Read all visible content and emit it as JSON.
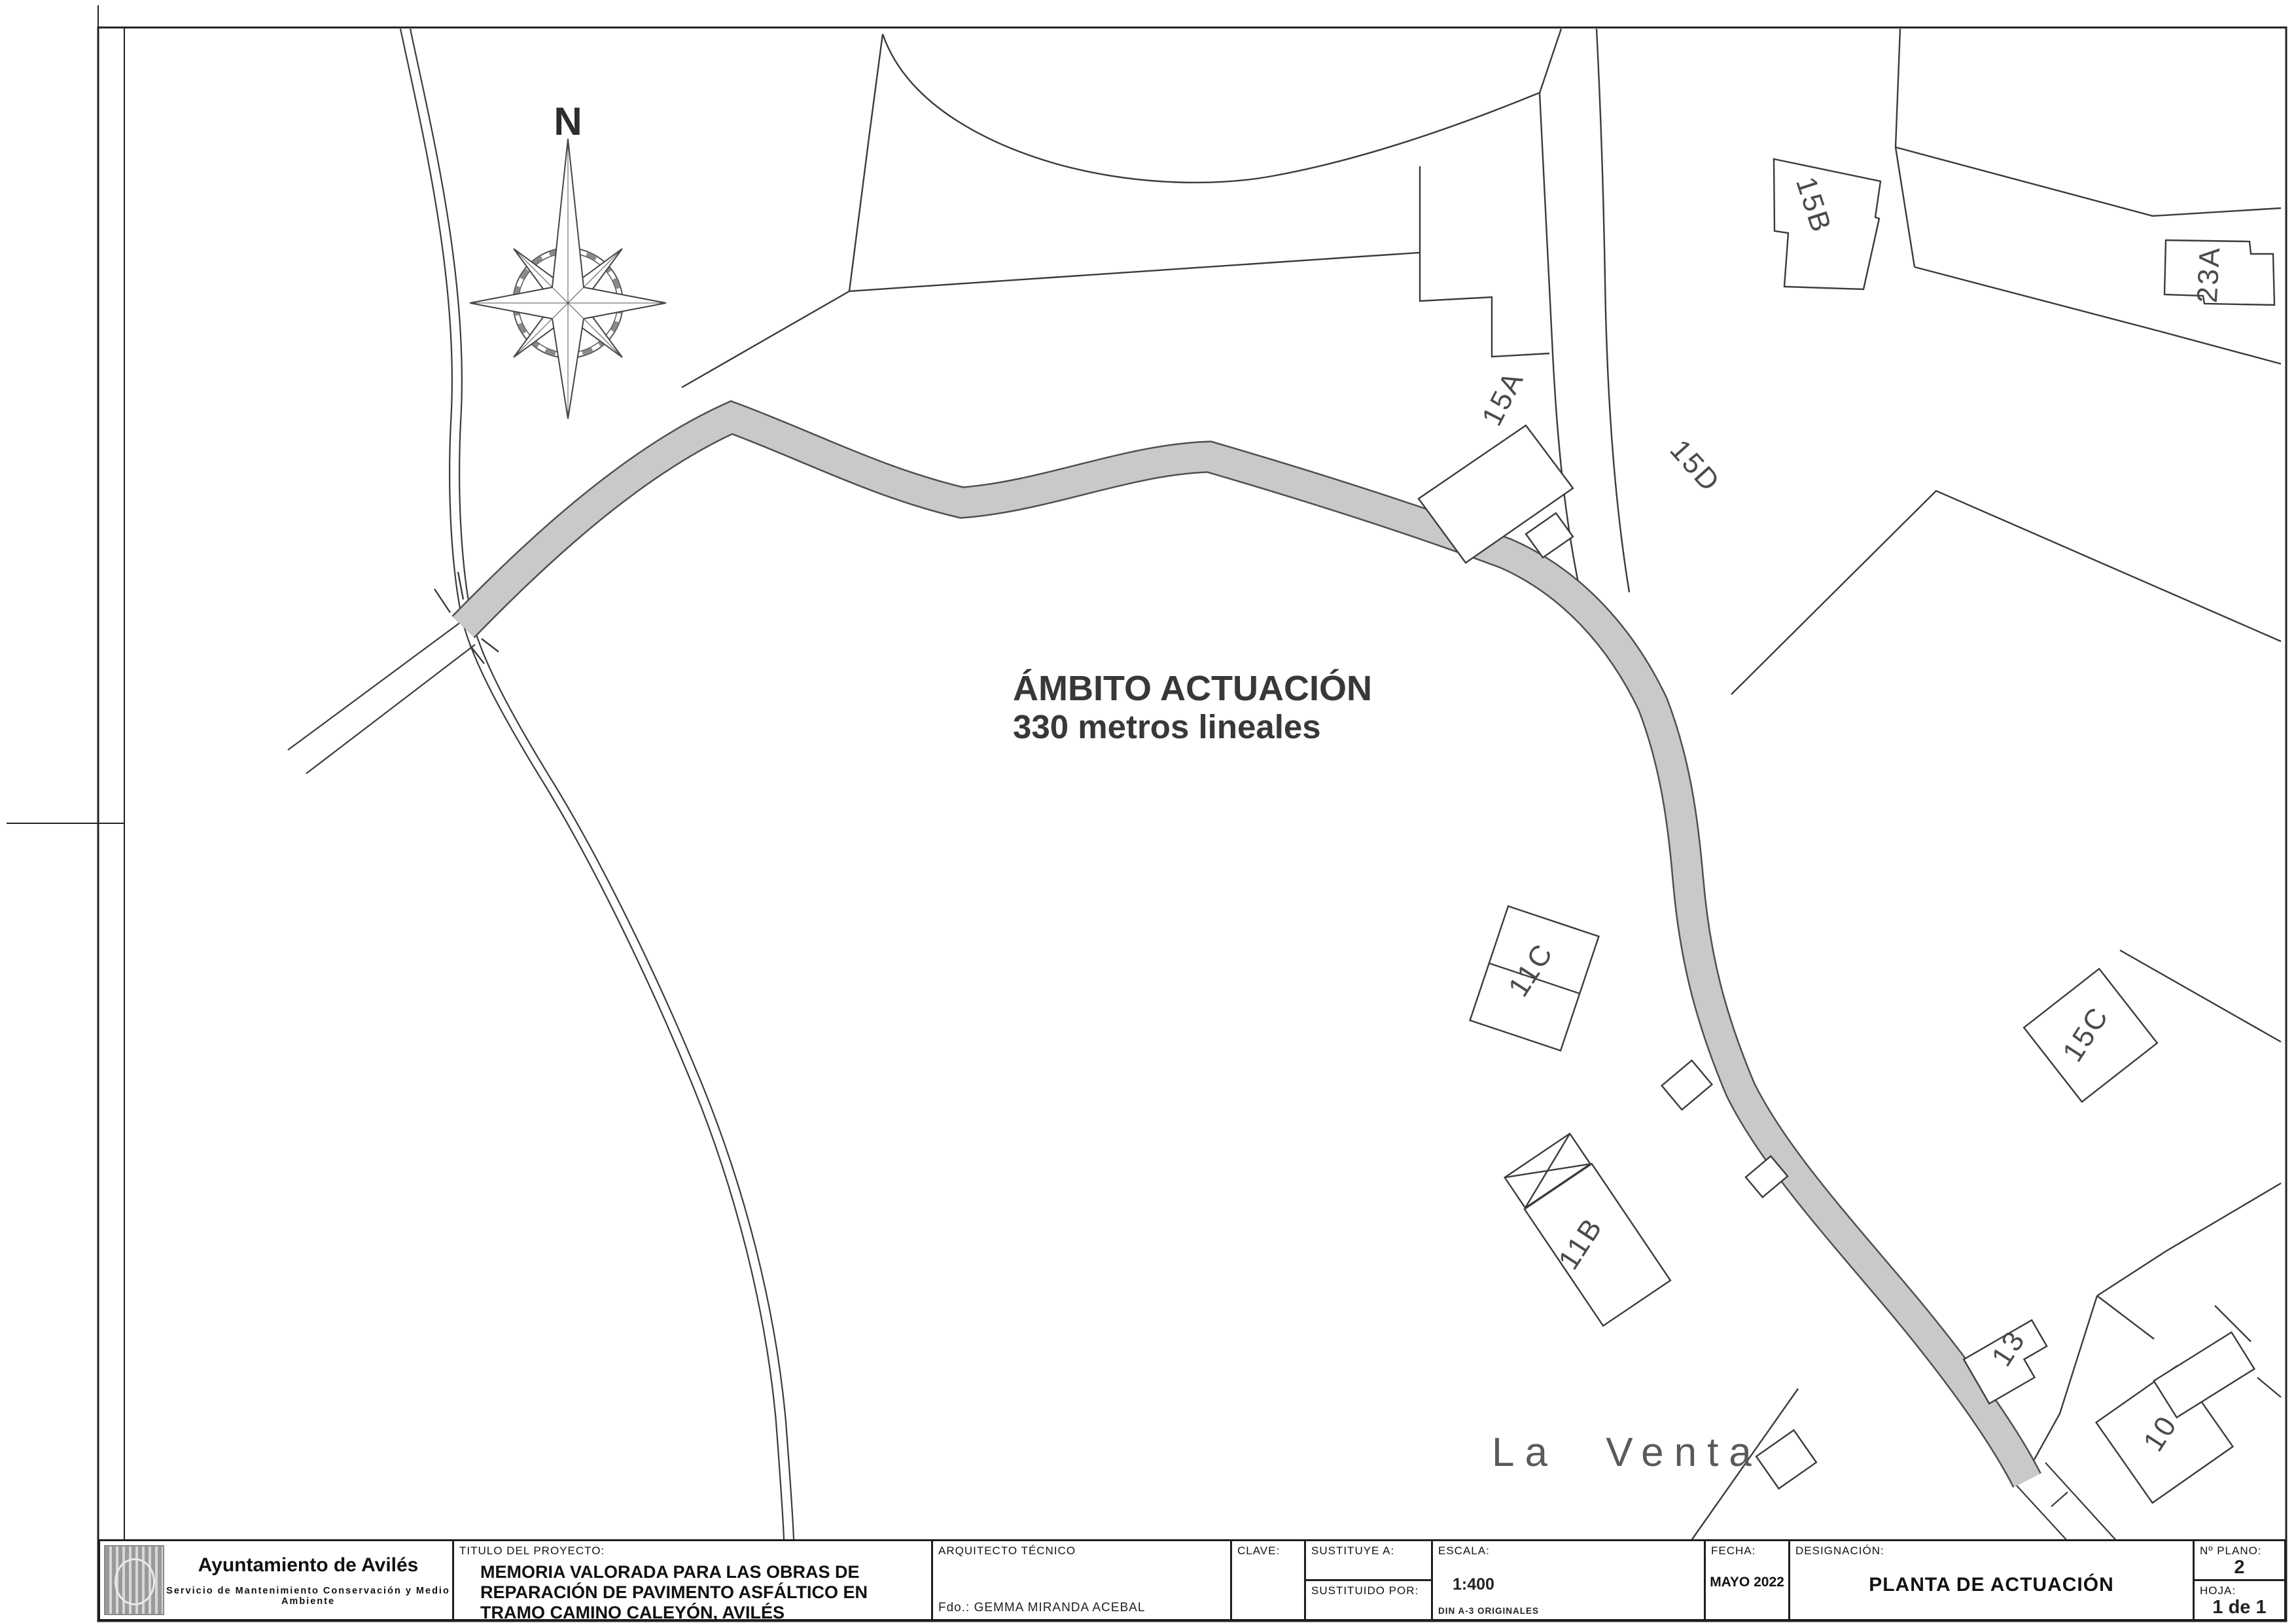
{
  "colors": {
    "paper": "#ffffff",
    "line": "#3b3b3b",
    "road_fill": "#c9c9c9",
    "road_edge": "#4f4f4f",
    "annotation_text": "#383838",
    "cad_text": "#4a4a4a"
  },
  "map": {
    "north_label": "N",
    "annotation_line1": "ÁMBITO ACTUACIÓN",
    "annotation_line2": "330 metros lineales",
    "place_name": "La Venta",
    "parcels": {
      "p15b": "15B",
      "p23a": "23A",
      "p15a": "15A",
      "p15d": "15D",
      "p11c": "11C",
      "p15c": "15C",
      "p11b": "11B",
      "p13": "13",
      "p10": "10"
    }
  },
  "title_block": {
    "entity_name": "Ayuntamiento de Avilés",
    "entity_department": "Servicio de Mantenimiento Conservación y Medio Ambiente",
    "project_label": "TITULO DEL PROYECTO:",
    "project_title": "MEMORIA VALORADA PARA LAS OBRAS DE REPARACIÓN DE PAVIMENTO ASFÁLTICO EN TRAMO CAMINO CALEYÓN, AVILÉS",
    "architect_label": "ARQUITECTO TÉCNICO",
    "signed": "Fdo.:  GEMMA MIRANDA ACEBAL",
    "clave_label": "CLAVE:",
    "sustituye_label": "SUSTITUYE A:",
    "sustituido_label": "SUSTITUIDO POR:",
    "escala_label": "ESCALA:",
    "escala_value": "1:400",
    "escala_note": "DIN A-3 ORIGINALES",
    "fecha_label": "FECHA:",
    "fecha_value": "MAYO 2022",
    "designacion_label": "DESIGNACIÓN:",
    "designacion_value": "PLANTA DE ACTUACIÓN",
    "plano_label": "Nº PLANO:",
    "plano_value": "2",
    "hoja_label": "HOJA:",
    "hoja_value": "1 de 1"
  }
}
